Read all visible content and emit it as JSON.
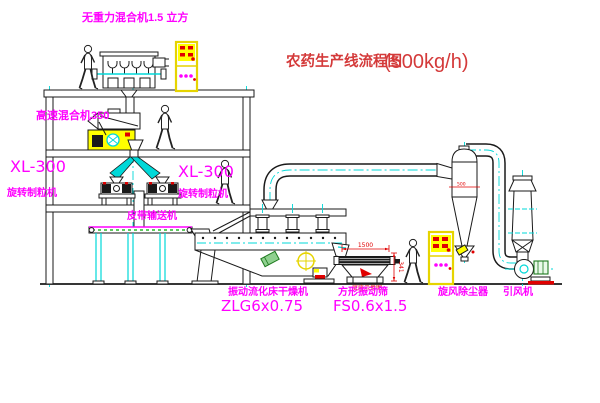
{
  "diagram": {
    "title": "农药生产线流程图",
    "capacity": "(500kg/h)"
  },
  "labels": {
    "gravity_mixer": "无重力混合机1.5 立方",
    "high_speed_mixer": "高速混合机350",
    "granulator_left_model": "XL-300",
    "granulator_left_name": "旋转制粒机",
    "granulator_right_model": "XL-300",
    "granulator_right_name": "旋转制粒机",
    "belt_conveyor": "皮带输送机",
    "dryer_name": "振动流化床干燥机",
    "dryer_model": "ZLG6x0.75",
    "sieve_name": "方形振动筛",
    "sieve_model": "FS0.6x1.5",
    "cyclone": "旋风除尘器",
    "fan": "引风机",
    "base_note": "底座示意图"
  },
  "dimensions": {
    "sieve_length": "1500",
    "sieve_height": "341",
    "cyclone_mark": "500"
  },
  "colors": {
    "label_magenta": "#ff00ff",
    "title_red": "#d43a3a",
    "dim_red": "#e00000",
    "machine_yellow": "#ffff00",
    "duct_cyan": "#00d8d8",
    "line_dark": "#1a1a1a",
    "conveyor_green": "#00a800"
  }
}
